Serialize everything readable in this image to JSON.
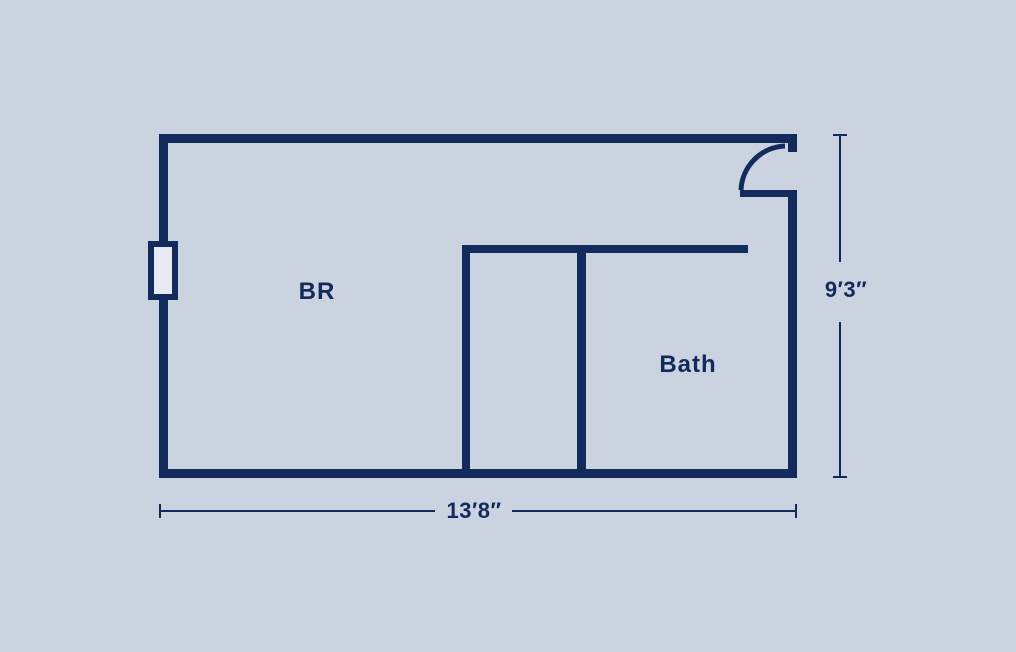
{
  "plan": {
    "rooms": [
      {
        "id": "bedroom",
        "label": "BR"
      },
      {
        "id": "bathroom",
        "label": "Bath"
      }
    ],
    "dimensions": {
      "width": "13′8″",
      "height": "9′3″"
    },
    "features": [
      {
        "id": "window",
        "icon": "window-icon",
        "location": "left-wall"
      },
      {
        "id": "door",
        "icon": "door-swing-icon",
        "location": "top-right-wall"
      }
    ]
  },
  "colors": {
    "background": "#ccd3e0",
    "wall": "#122b5c",
    "window_fill": "#e7eaf2"
  }
}
